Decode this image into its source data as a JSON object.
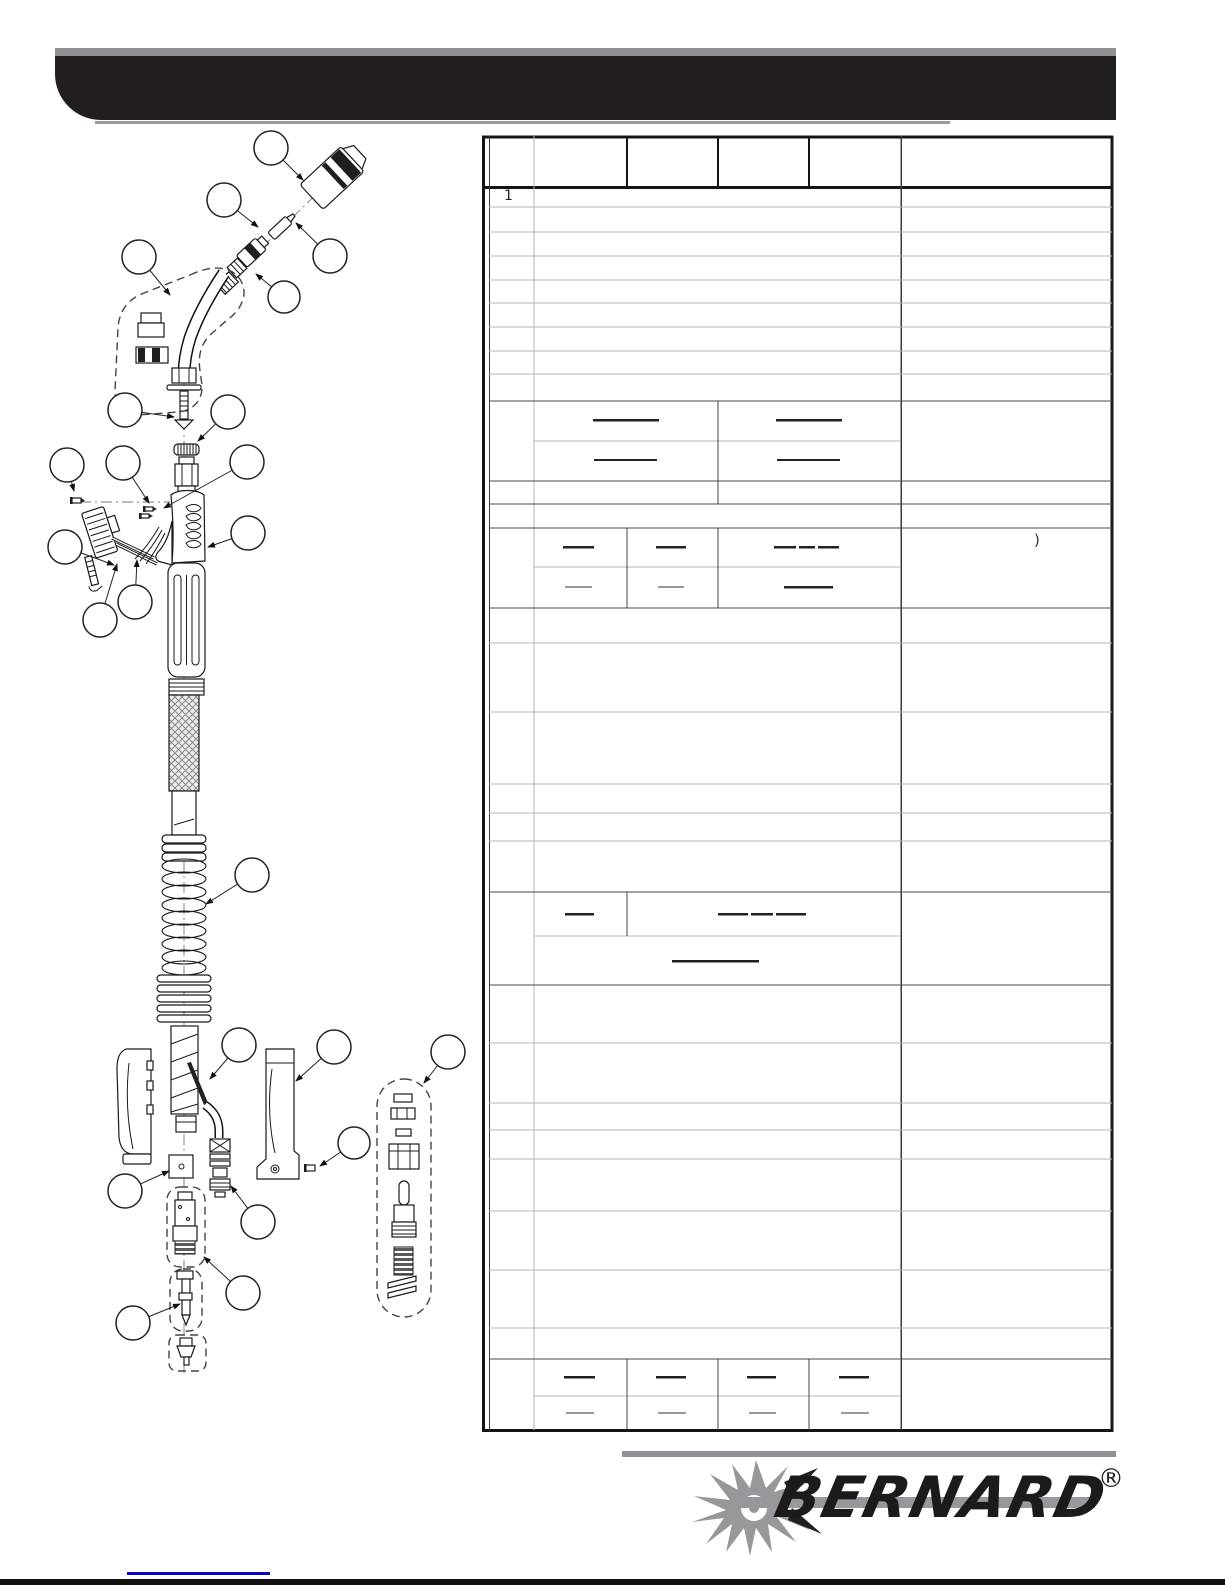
{
  "parts_table": {
    "item_1": "1",
    "stray_glyph": ")"
  },
  "brand": {
    "name": "BERNARD",
    "registered": "®"
  },
  "colors": {
    "banner_black": "#221e20",
    "banner_gray": "#8f9093",
    "grid_light": "#b5b5b5",
    "grid_dark": "#4a4a4a",
    "table_border": "#151515",
    "logo_gray": "#97989b",
    "link_blue": "#0b00c8"
  }
}
